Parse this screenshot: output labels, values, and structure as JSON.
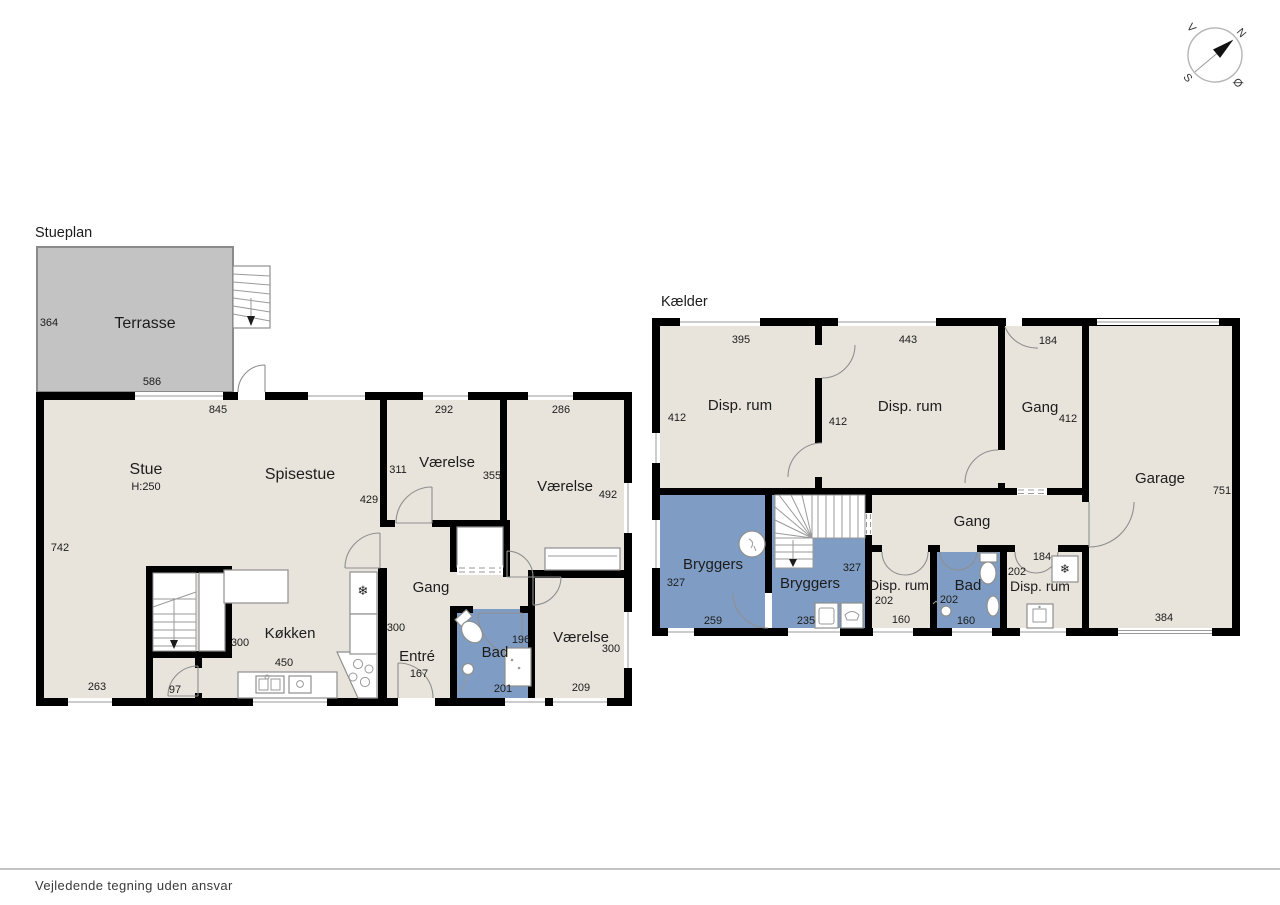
{
  "page": {
    "footer": "Vejledende tegning uden ansvar"
  },
  "compass": {
    "n": "N",
    "s": "S",
    "e": "Ø",
    "w": "V"
  },
  "stueplan": {
    "title": "Stueplan",
    "terrasse": {
      "label": "Terrasse",
      "left": "364",
      "bottom": "586"
    },
    "stue": {
      "label": "Stue",
      "ceiling": "H:250",
      "top": "845",
      "left": "742",
      "bottom": "263"
    },
    "spisestue": {
      "label": "Spisestue",
      "right": "429"
    },
    "vaerelse_nv": {
      "label": "Værelse",
      "top": "292",
      "left": "311",
      "right": "355"
    },
    "vaerelse_ne": {
      "label": "Værelse",
      "top": "286",
      "right": "492"
    },
    "gang": {
      "label": "Gang",
      "width": "300"
    },
    "koekken": {
      "label": "Køkken",
      "left": "300",
      "bottom": "450"
    },
    "vestibule": {
      "bottom": "97"
    },
    "entre": {
      "label": "Entré",
      "width": "167"
    },
    "bad": {
      "label": "Bad",
      "right": "196",
      "bottom": "201"
    },
    "vaerelse_se": {
      "label": "Værelse",
      "right": "300",
      "bottom": "209"
    }
  },
  "kaelder": {
    "title": "Kælder",
    "disp_nv": {
      "label": "Disp. rum",
      "top": "395",
      "left": "412"
    },
    "disp_n": {
      "label": "Disp. rum",
      "top": "443",
      "left": "412"
    },
    "gang_n": {
      "label": "Gang",
      "door": "184",
      "right": "412"
    },
    "garage": {
      "label": "Garage",
      "right": "751",
      "bottom": "384"
    },
    "bryggers_v": {
      "label": "Bryggers",
      "left": "327",
      "bottom": "259"
    },
    "bryggers_m": {
      "label": "Bryggers",
      "right": "327",
      "bottom": "235"
    },
    "gang_m": {
      "label": "Gang"
    },
    "disp_s1": {
      "label": "Disp. rum",
      "left": "202",
      "bottom": "160"
    },
    "bad": {
      "label": "Bad",
      "left": "202",
      "bottom": "160"
    },
    "disp_s2": {
      "label": "Disp. rum",
      "top": "184",
      "left": "202"
    }
  }
}
